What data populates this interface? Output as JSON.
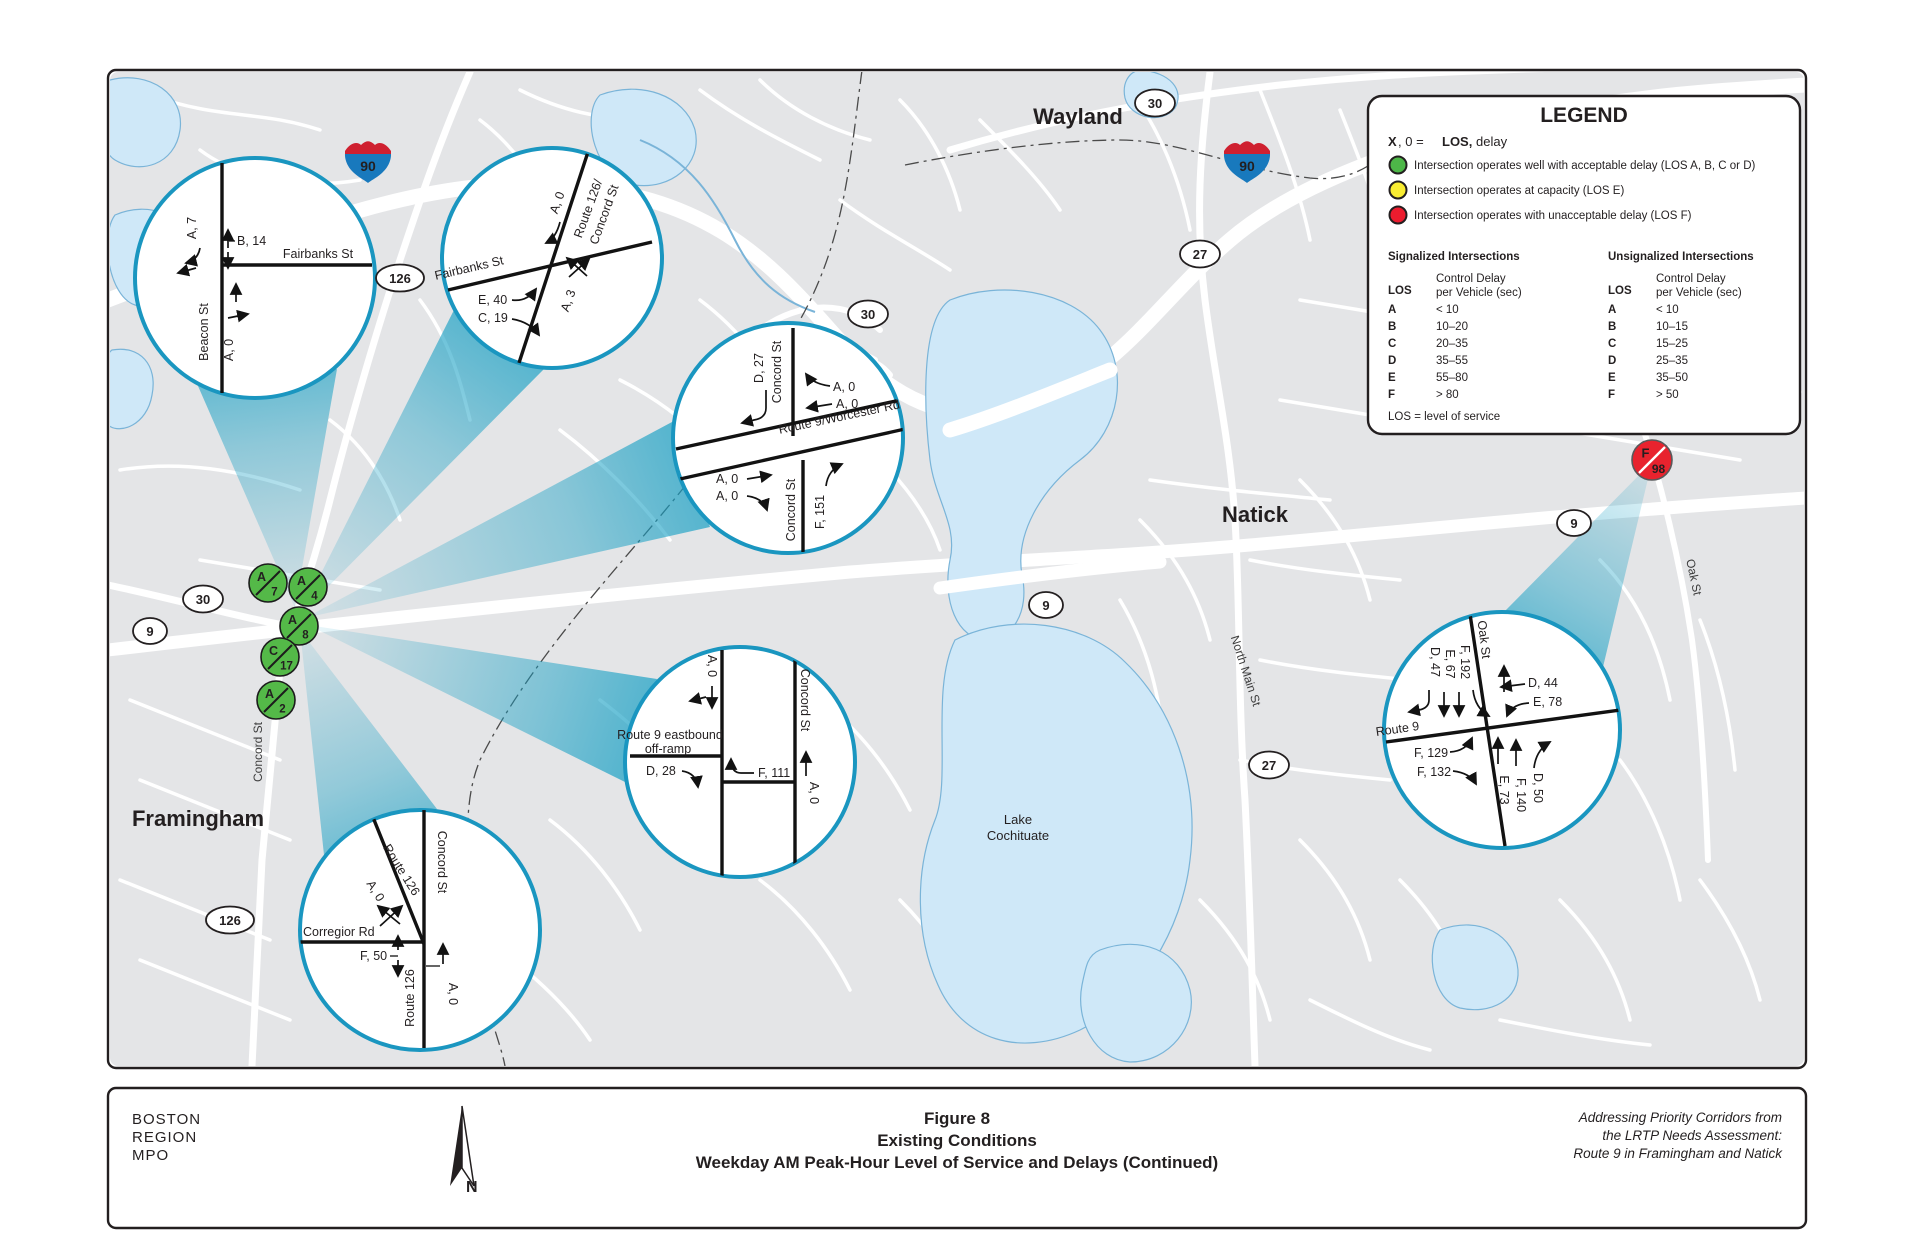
{
  "figure": {
    "org_line1": "BOSTON",
    "org_line2": "REGION",
    "org_line3": "MPO",
    "north_label": "N",
    "title_line1": "Figure 8",
    "title_line2": "Existing Conditions",
    "title_line3": "Weekday AM Peak-Hour Level of Service and Delays (Continued)",
    "credit_line1": "Addressing Priority Corridors from",
    "credit_line2": "the LRTP Needs Assessment:",
    "credit_line3": "Route 9 in Framingham and Natick"
  },
  "legend": {
    "title": "LEGEND",
    "key_x": "X",
    "key_mid": ", 0   =",
    "key_los": "LOS,",
    "key_delay": "delay",
    "bullets": [
      {
        "color": "#4db748",
        "label": "Intersection operates well with acceptable delay (LOS A, B, C or D)"
      },
      {
        "color": "#f9ed32",
        "label": "Intersection operates at capacity (LOS E)"
      },
      {
        "color": "#ec1c2e",
        "label": "Intersection operates with unacceptable delay (LOS F)"
      }
    ],
    "signalized": {
      "title": "Signalized Intersections",
      "los_header": "LOS",
      "delay_header_1": "Control Delay",
      "delay_header_2": "per Vehicle (sec)",
      "rows": [
        {
          "los": "A",
          "range": "< 10"
        },
        {
          "los": "B",
          "range": "10–20"
        },
        {
          "los": "C",
          "range": "20–35"
        },
        {
          "los": "D",
          "range": "35–55"
        },
        {
          "los": "E",
          "range": "55–80"
        },
        {
          "los": "F",
          "range": "> 80"
        }
      ]
    },
    "unsignalized": {
      "title": "Unsignalized Intersections",
      "los_header": "LOS",
      "delay_header_1": "Control Delay",
      "delay_header_2": "per Vehicle (sec)",
      "rows": [
        {
          "los": "A",
          "range": "< 10"
        },
        {
          "los": "B",
          "range": "10–15"
        },
        {
          "los": "C",
          "range": "15–25"
        },
        {
          "los": "D",
          "range": "25–35"
        },
        {
          "los": "E",
          "range": "35–50"
        },
        {
          "los": "F",
          "range": "> 50"
        }
      ]
    },
    "footnote": "LOS = level of service"
  },
  "map": {
    "towns": {
      "wayland": "Wayland",
      "natick": "Natick",
      "framingham": "Framingham"
    },
    "water_label_1": "Lake",
    "water_label_2": "Cochituate",
    "streets": {
      "north_main": "North Main St",
      "oak": "Oak St",
      "concord": "Concord St"
    },
    "shield_90": "90",
    "shield_30": "30",
    "shield_27": "27",
    "shield_9": "9",
    "shield_126": "126"
  },
  "markers": {
    "green_color": "#54b948",
    "red_color": "#e8232e",
    "callout_border": "#1a96c0",
    "green": [
      {
        "los": "A",
        "delay": "7"
      },
      {
        "los": "A",
        "delay": "4"
      },
      {
        "los": "A",
        "delay": "8"
      },
      {
        "los": "C",
        "delay": "17"
      },
      {
        "los": "A",
        "delay": "2"
      }
    ],
    "red": {
      "los": "F",
      "delay": "98"
    }
  },
  "callouts": {
    "c1": {
      "fairbanks": "Fairbanks St",
      "beacon": "Beacon St",
      "l_a7": "A, 7",
      "l_b14": "B, 14",
      "l_a0": "A, 0"
    },
    "c2": {
      "route126": "Route 126/",
      "concord": "Concord St",
      "fairbanks": "Fairbanks St",
      "l_a0": "A, 0",
      "l_e40": "E, 40",
      "l_c19": "C, 19",
      "l_a3": "A, 3"
    },
    "c3": {
      "main": "Route 9/Worcester Rd",
      "concord_n": "Concord St",
      "concord_s": "Concord St",
      "l_d27": "D, 27",
      "l_a0_1": "A, 0",
      "l_a0_2": "A, 0",
      "l_a0_3": "A, 0",
      "l_a0_4": "A, 0",
      "l_f151": "F, 151"
    },
    "c4": {
      "ramp1": "Route 9 eastbound",
      "ramp2": "off-ramp",
      "concord": "Concord St",
      "l_a0_top": "A, 0",
      "l_d28": "D, 28",
      "l_f111": "F, 111",
      "l_a0_right": "A, 0"
    },
    "c5": {
      "route126_diag": "Route 126",
      "concord": "Concord St",
      "route126_s": "Route 126",
      "corregior": "Corregior Rd",
      "l_a0_diag": "A, 0",
      "l_f50": "F, 50",
      "l_a0_right": "A, 0"
    },
    "c6": {
      "oak": "Oak St",
      "route9": "Route 9",
      "nw": [
        "F, 192",
        "E, 67",
        "D, 47"
      ],
      "ne": [
        "D, 44",
        "E, 78"
      ],
      "sw": [
        "F, 129",
        "F, 132"
      ],
      "se": [
        "E, 73",
        "F, 140",
        "D, 50"
      ]
    }
  }
}
